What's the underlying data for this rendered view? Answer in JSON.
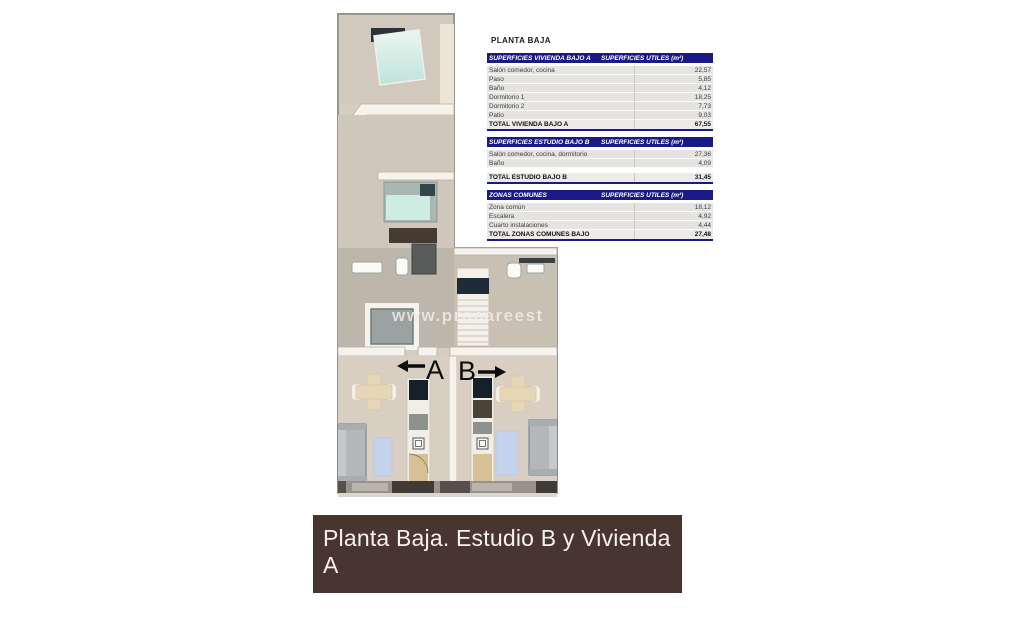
{
  "page": {
    "background": "#ffffff"
  },
  "panel": {
    "title": "PLANTA BAJA"
  },
  "tables": [
    {
      "header_left": "SUPERFICIES VIVIENDA BAJO A",
      "header_right": "SUPERFICIES UTILES  (m²)",
      "rows": [
        [
          "Salón comedor, cocina",
          "22,57"
        ],
        [
          "Paso",
          "5,85"
        ],
        [
          "Baño",
          "4,12"
        ],
        [
          "Dormitorio 1",
          "18,25"
        ],
        [
          "Dormitorio 2",
          "7,73"
        ],
        [
          "Patio",
          "9,03"
        ]
      ],
      "gap_before_total": false,
      "total": [
        "TOTAL VIVIENDA BAJO A",
        "67,55"
      ]
    },
    {
      "header_left": "SUPERFICIES ESTUDIO BAJO B",
      "header_right": "SUPERFICIES UTILES  (m²)",
      "rows": [
        [
          "Salón comedor, cocina, dormitorio",
          "27,36"
        ],
        [
          "Baño",
          "4,09"
        ]
      ],
      "gap_before_total": true,
      "total": [
        "TOTAL ESTUDIO BAJO B",
        "31,45"
      ]
    },
    {
      "header_left": "ZONAS COMUNES",
      "header_right": "SUPERFICIES UTILES  (m²)",
      "rows": [
        [
          "Zona común",
          "18,12"
        ],
        [
          "Escalera",
          "4,92"
        ],
        [
          "Cuarto instalaciones",
          "4,44"
        ]
      ],
      "gap_before_total": false,
      "total": [
        "TOTAL ZONAS COMUNES BAJO",
        "27,48"
      ]
    }
  ],
  "plan": {
    "watermark": "www.procareest",
    "unit_a_label": "A",
    "unit_b_label": "B",
    "colors": {
      "header_navy": "#191987",
      "floor_beige": "#d5cdc1",
      "wall_white": "#f6f3ec",
      "bed_teal": "#cdece4",
      "rug_blue": "#c5d2ec",
      "banner_brown": "#49352f"
    }
  },
  "banner": {
    "text": "Planta Baja. Estudio B y Vivienda A"
  }
}
